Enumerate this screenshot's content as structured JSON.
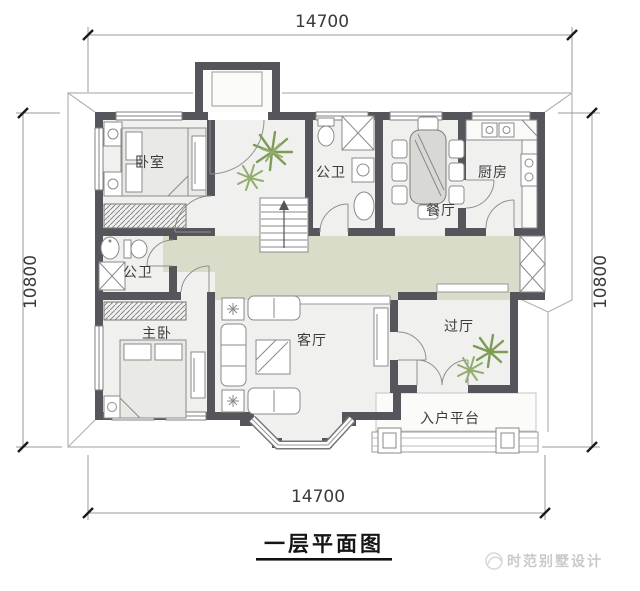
{
  "plan": {
    "title": "一层平面图",
    "watermark": "时范别墅设计",
    "dimensions": {
      "top": "14700",
      "bottom": "14700",
      "left": "10800",
      "right": "10800"
    },
    "rooms": {
      "bedroom": "卧室",
      "bath_top": "公卫",
      "dining": "餐厅",
      "kitchen": "厨房",
      "bath_left": "公卫",
      "master_bedroom": "主卧",
      "living_room": "客厅",
      "hallway": "过厅",
      "entry_platform": "入户平台"
    },
    "colors": {
      "wall": "#55565b",
      "corridor_floor": "#d8dcc8",
      "room_floor": "#f0f0ef",
      "plant": "#7d9c55",
      "dimension_text": "#3a3a3a",
      "watermark_gray": "#c9c9c9"
    }
  }
}
